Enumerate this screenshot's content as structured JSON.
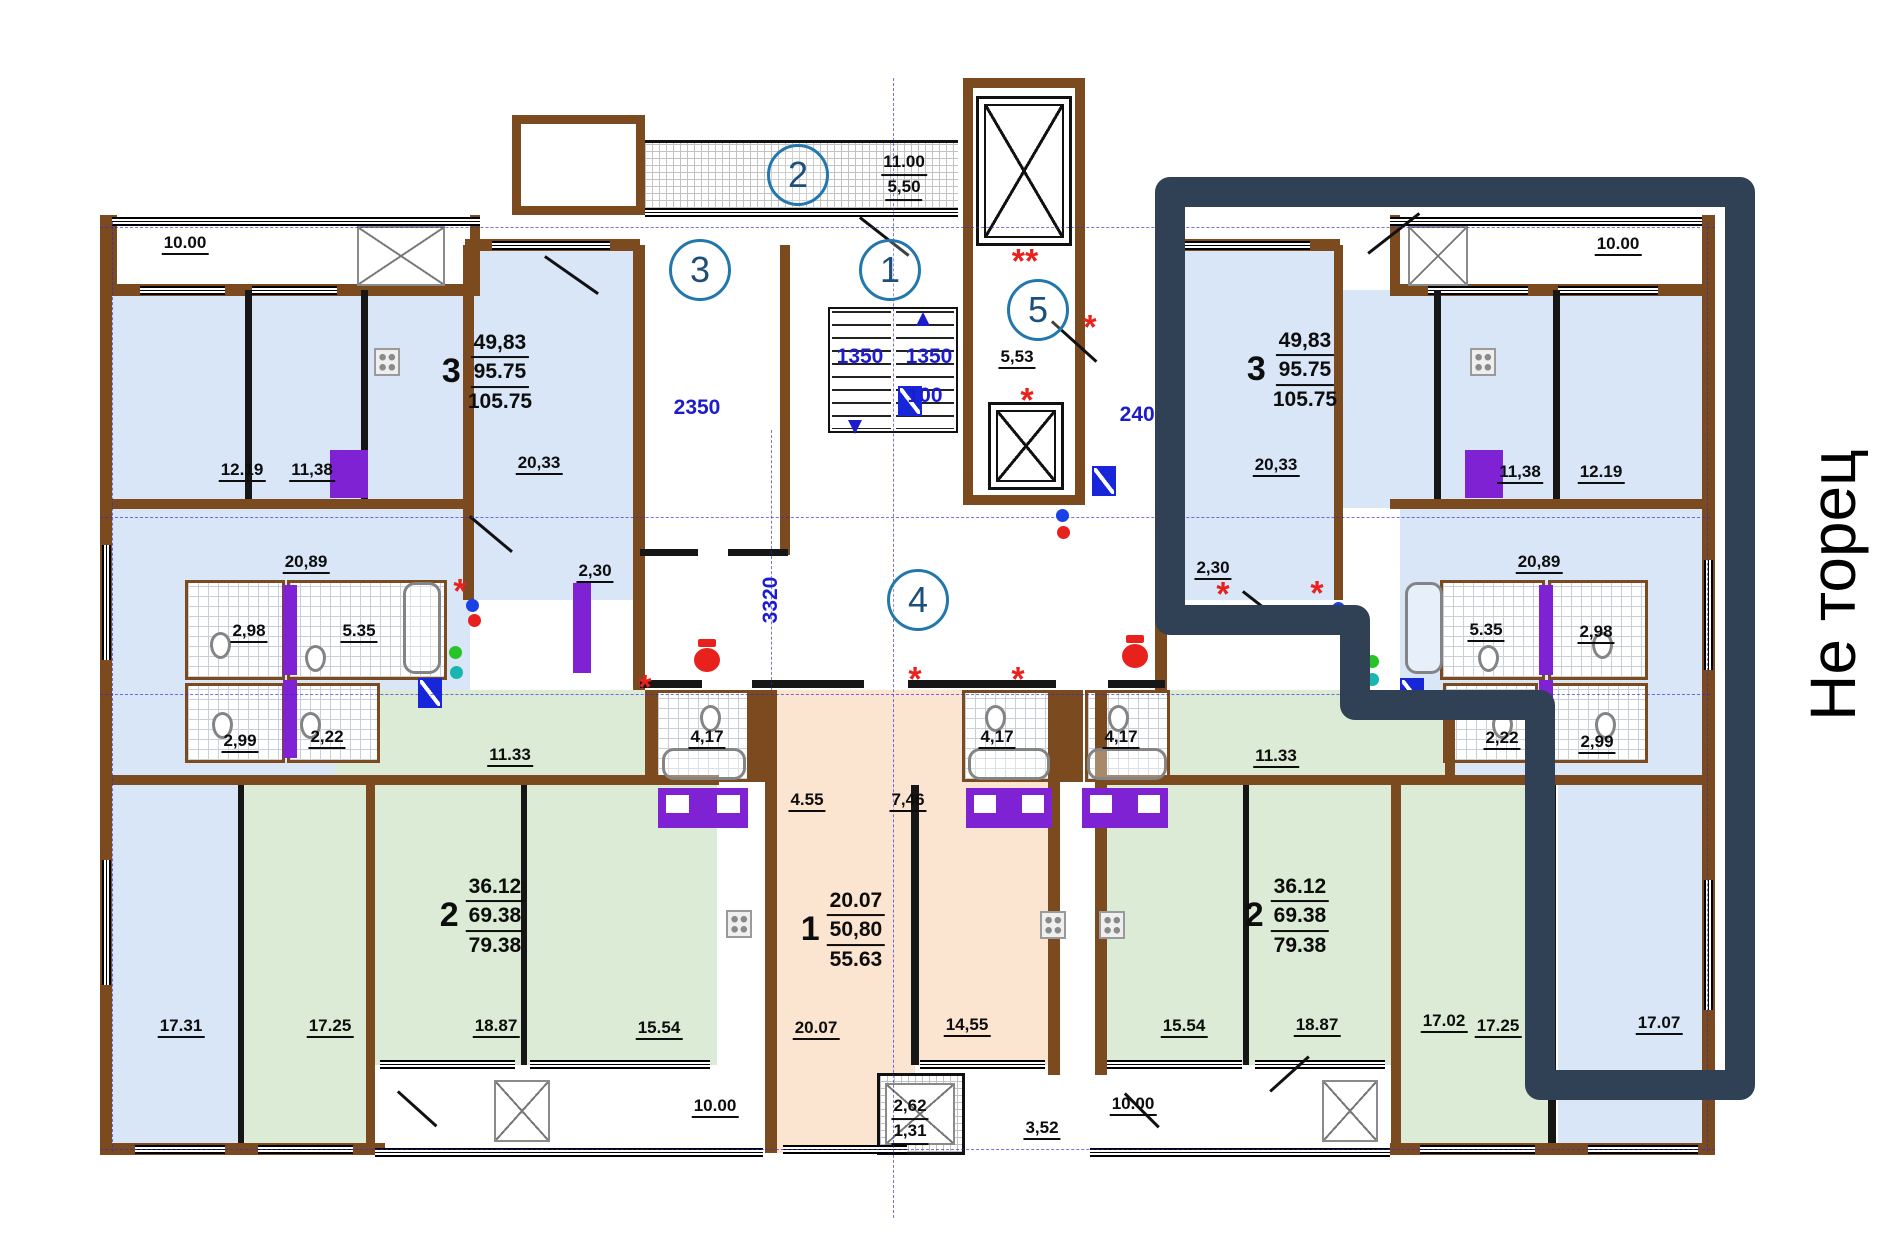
{
  "plan": {
    "note": "Не торец",
    "axes": {
      "c1": "1",
      "c2": "2",
      "c3": "3",
      "c4": "4",
      "c5": "5"
    },
    "dims": {
      "w2350": "2350",
      "h3320": "3320",
      "w2400": "2400",
      "s1350a": "1350",
      "s1350b": "1350",
      "s100": "100"
    },
    "marks": {
      "ds": "**",
      "s1": "*",
      "s2": "*",
      "s3": "*",
      "s4": "*",
      "s5": "*",
      "s6": "*",
      "s7": "*",
      "s8": "*"
    },
    "balconies": {
      "tl": "10.00",
      "tr": "10.00",
      "bl": "10.00",
      "br": "10.00",
      "tc_a": "11.00",
      "tc_b": "5,50",
      "small_a": "2,62",
      "small_b": "1,31",
      "lobby": "5,53",
      "a352": "3,52"
    },
    "apt3l": {
      "n": "3",
      "a": "49,83",
      "b": "95.75",
      "c": "105.75"
    },
    "apt3r": {
      "n": "3",
      "a": "49,83",
      "b": "95.75",
      "c": "105.75"
    },
    "apt2l": {
      "n": "2",
      "a": "36.12",
      "b": "69.38",
      "c": "79.38"
    },
    "apt2r": {
      "n": "2",
      "a": "36.12",
      "b": "69.38",
      "c": "79.38"
    },
    "apt1": {
      "n": "1",
      "a": "20.07",
      "b": "50,80",
      "c": "55.63"
    },
    "roomsL": {
      "r1219": "12.19",
      "r1138": "11,38",
      "r2033": "20,33",
      "r230": "2,30",
      "r2089": "20,89",
      "r298": "2,98",
      "r535": "5.35",
      "r299": "2,99",
      "r222": "2,22",
      "r1133": "11.33",
      "r1731": "17.31",
      "r1725": "17.25",
      "r1887": "18.87",
      "r1554": "15.54"
    },
    "roomsR": {
      "r1219": "12.19",
      "r1138": "11,38",
      "r2033": "20,33",
      "r230": "2,30",
      "r2089": "20,89",
      "r298": "2,98",
      "r535": "5.35",
      "r299": "2,99",
      "r222": "2,22",
      "r1133": "11.33",
      "r1554": "15.54",
      "r1887": "18.87",
      "r1702": "17.02",
      "r1725": "17.25",
      "r1707": "17.07"
    },
    "roomsC": {
      "r417a": "4,17",
      "r417b": "4,17",
      "r417c": "4,17",
      "r455": "4.55",
      "r746": "7,46",
      "r2007": "20.07",
      "r1455": "14,55"
    }
  }
}
